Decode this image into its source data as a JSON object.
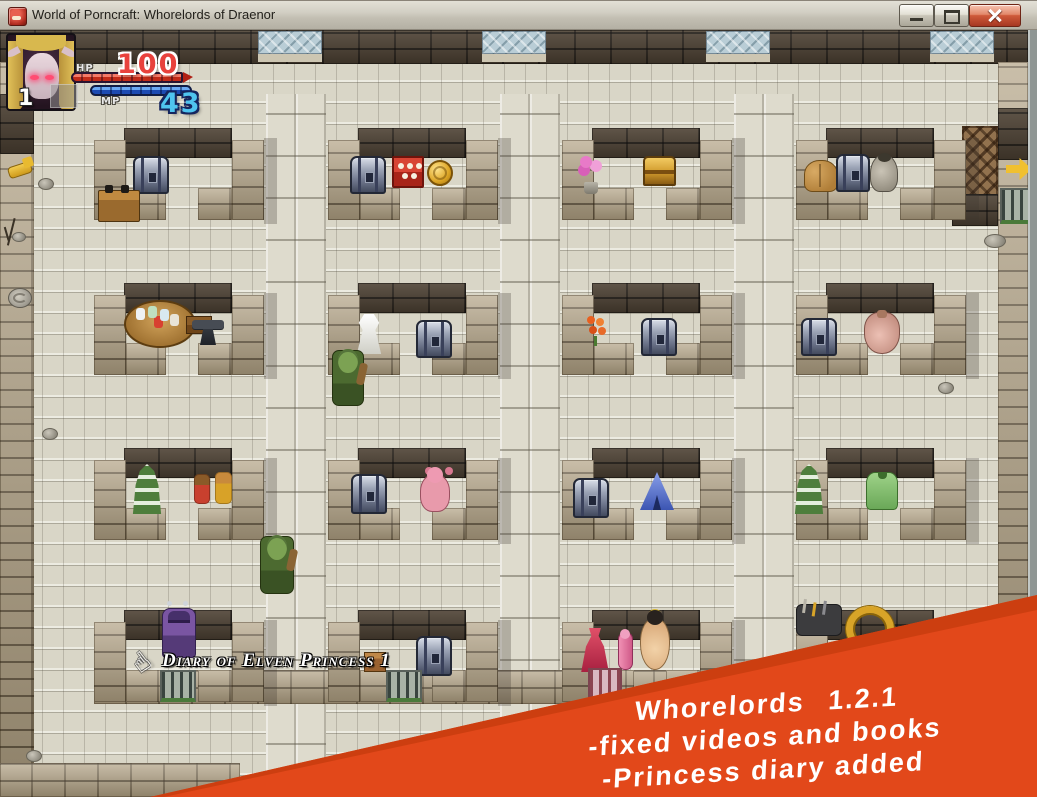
{
  "window": {
    "title": "World of Porncraft: Whorelords of Draenor"
  },
  "hud": {
    "level": "1",
    "hp": {
      "label": "HP",
      "value": "100"
    },
    "mp": {
      "label": "MP",
      "value": "43"
    }
  },
  "tooltip": {
    "text": "Diary of Elven Princess 1"
  },
  "icons": {
    "hand_cursor": "☝"
  },
  "banner": {
    "color": "#e2481a",
    "lines": [
      "Whorelords 1.2.1",
      "-fixed videos and books",
      "-Princess diary added"
    ]
  },
  "colors": {
    "hp_red": "#e8413c",
    "mp_blue": "#4fc4ef",
    "wall_tan": "#b2a284",
    "wall_dark": "#4e4234",
    "floor": "#d9d6c7"
  },
  "map": {
    "rooms": [
      {
        "x": 94,
        "y": 128
      },
      {
        "x": 328,
        "y": 128
      },
      {
        "x": 562,
        "y": 128
      },
      {
        "x": 796,
        "y": 128
      },
      {
        "x": 94,
        "y": 283
      },
      {
        "x": 328,
        "y": 283
      },
      {
        "x": 562,
        "y": 283
      },
      {
        "x": 796,
        "y": 283
      },
      {
        "x": 94,
        "y": 448
      },
      {
        "x": 328,
        "y": 448
      },
      {
        "x": 562,
        "y": 448
      },
      {
        "x": 796,
        "y": 448
      },
      {
        "x": 94,
        "y": 610
      },
      {
        "x": 328,
        "y": 610
      },
      {
        "x": 562,
        "y": 610
      },
      {
        "x": 796,
        "y": 610
      }
    ],
    "corridors": [
      266,
      500,
      734
    ],
    "wall_windows": [
      258,
      482,
      706,
      930
    ],
    "entities": [
      {
        "name": "metal-chest",
        "kind": "metal-chest",
        "x": 133,
        "y": 156,
        "w": 36,
        "h": 38,
        "clickable": true
      },
      {
        "name": "wood-table",
        "kind": "wood-table",
        "x": 98,
        "y": 190,
        "w": 40,
        "h": 30,
        "clickable": true
      },
      {
        "name": "metal-chest",
        "kind": "metal-chest",
        "x": 350,
        "y": 156,
        "w": 36,
        "h": 38,
        "clickable": true
      },
      {
        "name": "tnt-crate",
        "kind": "tnt-crate",
        "x": 392,
        "y": 156,
        "w": 32,
        "h": 32,
        "clickable": true
      },
      {
        "name": "gold-coin",
        "kind": "gold-coin",
        "x": 427,
        "y": 160,
        "w": 26,
        "h": 26,
        "clickable": true
      },
      {
        "name": "pink-orchid",
        "kind": "pink-orchid",
        "x": 578,
        "y": 156,
        "w": 28,
        "h": 38,
        "clickable": true
      },
      {
        "name": "gold-chest",
        "kind": "gold-chest",
        "x": 643,
        "y": 156,
        "w": 33,
        "h": 30,
        "clickable": true
      },
      {
        "name": "hay-sacks",
        "kind": "hay-sacks",
        "x": 804,
        "y": 160,
        "w": 34,
        "h": 32,
        "clickable": true
      },
      {
        "name": "metal-chest",
        "kind": "metal-chest",
        "x": 836,
        "y": 154,
        "w": 34,
        "h": 38,
        "clickable": true
      },
      {
        "name": "gray-sack",
        "kind": "gray-sack",
        "x": 870,
        "y": 154,
        "w": 28,
        "h": 38,
        "clickable": true
      },
      {
        "name": "alchemy-table",
        "kind": "alchemy-table",
        "x": 124,
        "y": 300,
        "w": 72,
        "h": 48,
        "clickable": true
      },
      {
        "name": "anvil",
        "kind": "anvil",
        "x": 192,
        "y": 316,
        "w": 32,
        "h": 34,
        "clickable": true
      },
      {
        "name": "white-dress",
        "kind": "white-dress",
        "x": 353,
        "y": 314,
        "w": 32,
        "h": 40,
        "clickable": true
      },
      {
        "name": "metal-chest",
        "kind": "metal-chest",
        "x": 416,
        "y": 320,
        "w": 36,
        "h": 38,
        "clickable": true
      },
      {
        "name": "orc-npc",
        "kind": "orc-npc",
        "x": 332,
        "y": 350,
        "w": 32,
        "h": 56,
        "clickable": true
      },
      {
        "name": "orange-flowers",
        "kind": "orange-flowers",
        "x": 583,
        "y": 314,
        "w": 26,
        "h": 32,
        "clickable": true
      },
      {
        "name": "metal-chest",
        "kind": "metal-chest",
        "x": 641,
        "y": 318,
        "w": 36,
        "h": 38,
        "clickable": true
      },
      {
        "name": "metal-chest",
        "kind": "metal-chest",
        "x": 801,
        "y": 318,
        "w": 36,
        "h": 38,
        "clickable": true
      },
      {
        "name": "pink-sack",
        "kind": "pink-sack",
        "x": 864,
        "y": 312,
        "w": 36,
        "h": 42,
        "clickable": true
      },
      {
        "name": "green-tier-plant",
        "kind": "green-tier-plant",
        "x": 132,
        "y": 464,
        "w": 30,
        "h": 50,
        "clickable": true
      },
      {
        "name": "plush-pair",
        "kind": "plush-pair",
        "x": 192,
        "y": 472,
        "w": 42,
        "h": 36,
        "clickable": true
      },
      {
        "name": "metal-chest",
        "kind": "metal-chest",
        "x": 351,
        "y": 474,
        "w": 36,
        "h": 40,
        "clickable": true
      },
      {
        "name": "pink-teddy",
        "kind": "pink-teddy",
        "x": 420,
        "y": 474,
        "w": 30,
        "h": 38,
        "clickable": true
      },
      {
        "name": "metal-chest",
        "kind": "metal-chest",
        "x": 573,
        "y": 478,
        "w": 36,
        "h": 40,
        "clickable": true
      },
      {
        "name": "blue-tent",
        "kind": "blue-tent",
        "x": 640,
        "y": 472,
        "w": 34,
        "h": 38,
        "clickable": true
      },
      {
        "name": "green-tier-plant",
        "kind": "green-tier-plant",
        "x": 794,
        "y": 464,
        "w": 30,
        "h": 50,
        "clickable": true
      },
      {
        "name": "green-shirt",
        "kind": "green-shirt",
        "x": 866,
        "y": 472,
        "w": 32,
        "h": 38,
        "clickable": true
      },
      {
        "name": "orc-npc",
        "kind": "orc-npc",
        "x": 260,
        "y": 536,
        "w": 34,
        "h": 58,
        "clickable": true
      },
      {
        "name": "succubus-npc",
        "kind": "succubus-npc",
        "x": 162,
        "y": 608,
        "w": 34,
        "h": 50,
        "clickable": true
      },
      {
        "name": "metal-chest",
        "kind": "metal-chest",
        "x": 416,
        "y": 636,
        "w": 36,
        "h": 40,
        "clickable": true
      },
      {
        "name": "red-dress",
        "kind": "red-dress",
        "x": 580,
        "y": 628,
        "w": 30,
        "h": 44,
        "clickable": true
      },
      {
        "name": "pink-rod",
        "kind": "pink-rod",
        "x": 618,
        "y": 632,
        "w": 15,
        "h": 38,
        "clickable": true
      },
      {
        "name": "nude-girl",
        "kind": "nude-girl",
        "x": 640,
        "y": 618,
        "w": 30,
        "h": 52,
        "clickable": true
      },
      {
        "name": "dark-tools",
        "kind": "dark-tools",
        "x": 796,
        "y": 604,
        "w": 46,
        "h": 32,
        "clickable": false
      },
      {
        "name": "gold-horn",
        "kind": "gold-horn",
        "x": 846,
        "y": 606,
        "w": 48,
        "h": 46,
        "clickable": true
      },
      {
        "name": "gate",
        "kind": "gate",
        "x": 160,
        "y": 670,
        "w": 36,
        "h": 32,
        "clickable": true
      },
      {
        "name": "gate",
        "kind": "gate",
        "x": 386,
        "y": 670,
        "w": 36,
        "h": 32,
        "clickable": true
      },
      {
        "name": "gate-pink",
        "kind": "gate-pink",
        "x": 588,
        "y": 668,
        "w": 34,
        "h": 30,
        "clickable": true
      },
      {
        "name": "gate",
        "kind": "gate",
        "x": 1000,
        "y": 188,
        "w": 30,
        "h": 36,
        "clickable": true
      },
      {
        "name": "yellow-key",
        "kind": "yellow-key",
        "x": 8,
        "y": 164,
        "w": 24,
        "h": 12,
        "clickable": true
      },
      {
        "name": "yellow-arrow",
        "kind": "yellow-arrow",
        "x": 1006,
        "y": 158,
        "w": 26,
        "h": 22,
        "clickable": false
      },
      {
        "name": "diary-book",
        "kind": "diary-book",
        "x": 364,
        "y": 652,
        "w": 22,
        "h": 20,
        "clickable": true
      },
      {
        "name": "pebble",
        "kind": "pebble",
        "x": 38,
        "y": 178,
        "w": 16,
        "h": 12,
        "clickable": false
      },
      {
        "name": "pebble",
        "kind": "pebble",
        "x": 12,
        "y": 232,
        "w": 14,
        "h": 10,
        "clickable": false
      },
      {
        "name": "pebble",
        "kind": "pebble",
        "x": 42,
        "y": 428,
        "w": 16,
        "h": 12,
        "clickable": false
      },
      {
        "name": "pebble",
        "kind": "pebble",
        "x": 26,
        "y": 750,
        "w": 16,
        "h": 12,
        "clickable": false
      },
      {
        "name": "pebble",
        "kind": "pebble",
        "x": 984,
        "y": 234,
        "w": 22,
        "h": 14,
        "clickable": false
      },
      {
        "name": "pebble",
        "kind": "pebble",
        "x": 938,
        "y": 382,
        "w": 16,
        "h": 12,
        "clickable": false
      },
      {
        "name": "stone-swirl",
        "kind": "stone-swirl",
        "x": 8,
        "y": 288,
        "w": 24,
        "h": 20,
        "clickable": false
      },
      {
        "name": "wall-crack",
        "kind": "wall-crack",
        "x": 10,
        "y": 220,
        "w": 18,
        "h": 28,
        "clickable": false
      }
    ]
  }
}
